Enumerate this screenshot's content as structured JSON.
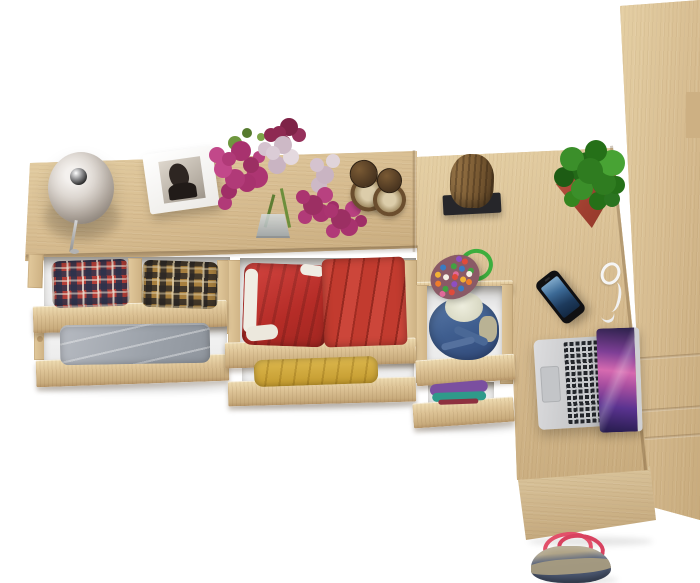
{
  "scene": {
    "label": "Top view of a Sonoma oak furniture set: dresser with open drawers of folded clothes, corner desk with laptop and accessories, wardrobe column, and a tote bag",
    "background": "#ffffff",
    "palette": {
      "wood_light": "#e6d1a6",
      "wood_base": "#d7bd92",
      "wood_dark": "#c7aa7c",
      "drawer_interior": "#ededed"
    },
    "items": {
      "table_lamp": {
        "label": "table lamp",
        "shade": "#d9d4cf",
        "hub": "#6e6e70"
      },
      "photo_frame": {
        "label": "white photo frame with black and white portrait",
        "frame": "#ffffff",
        "photo": "#2e2622"
      },
      "flower_bouquet": {
        "label": "bouquet of magenta, dark red and lilac flowers",
        "magenta": "#b13a78",
        "dark_red": "#8e2a52",
        "lilac": "#d9c9d4",
        "green": "#6f973f"
      },
      "vase": {
        "label": "glass vase",
        "color": "#aab2b6"
      },
      "hourglasses": {
        "label": "two bronze hourglasses",
        "bronze": "#5b4327",
        "sand": "#d9c9a8"
      },
      "log_stool": {
        "label": "log stool on black base",
        "wood": "#8a6a42",
        "base": "#26262a"
      },
      "pompom_keychain": {
        "label": "green rope keychain with multicolor pompoms",
        "rope": "#3dae3e",
        "pompoms": [
          "#e04b3a",
          "#f2b234",
          "#3a7bc2",
          "#42a142",
          "#8e4ec2",
          "#f07c2a",
          "#f5f0e6",
          "#e06a9a"
        ]
      },
      "potted_plant": {
        "label": "green plant in red square pot",
        "foliage": "#2f7c20",
        "pot": "#b24a3c"
      },
      "smartphone": {
        "label": "smartphone with blue screen",
        "body": "#141414",
        "screen": "#2e5d8e"
      },
      "earphones": {
        "label": "white earphones",
        "color": "#f4f4f4"
      },
      "laptop": {
        "label": "open laptop with purple space wallpaper",
        "body": "#d2d2d4",
        "keys": "#23262b",
        "screen": [
          "#241b4a",
          "#a84fa0",
          "#d66ab0",
          "#2a2149"
        ]
      },
      "tote_bag": {
        "label": "denim and beige tote bag with red handles",
        "body": "#4c5871",
        "trim": "#b0a488",
        "handles": "#e2506a"
      },
      "plaid_shirt_red": {
        "label": "folded red and navy plaid shirt",
        "colors": [
          "#b43f38",
          "#2b324c",
          "#ece6d8"
        ]
      },
      "plaid_shirt_brown": {
        "label": "folded brown and black plaid shirt",
        "colors": [
          "#a8803f",
          "#2a2624",
          "#decEaa"
        ]
      },
      "gray_trousers": {
        "label": "folded gray trousers",
        "color": "#a7abb2"
      },
      "red_shorts": {
        "label": "red shorts with white waistband",
        "colors": [
          "#c5332f",
          "#f2efe8"
        ]
      },
      "red_stack": {
        "label": "stack of folded red clothes",
        "color": "#c23b2f"
      },
      "yellow_shirt": {
        "label": "folded yellow shirt",
        "color": "#d2a93c"
      },
      "denim_jacket": {
        "label": "denim jacket with cream lining",
        "colors": [
          "#3f5e8f",
          "#e7e7d9"
        ]
      },
      "small_folded_stack": {
        "label": "folded purple and teal clothes",
        "colors": [
          "#7b4fa0",
          "#2f9a8a"
        ]
      }
    }
  }
}
